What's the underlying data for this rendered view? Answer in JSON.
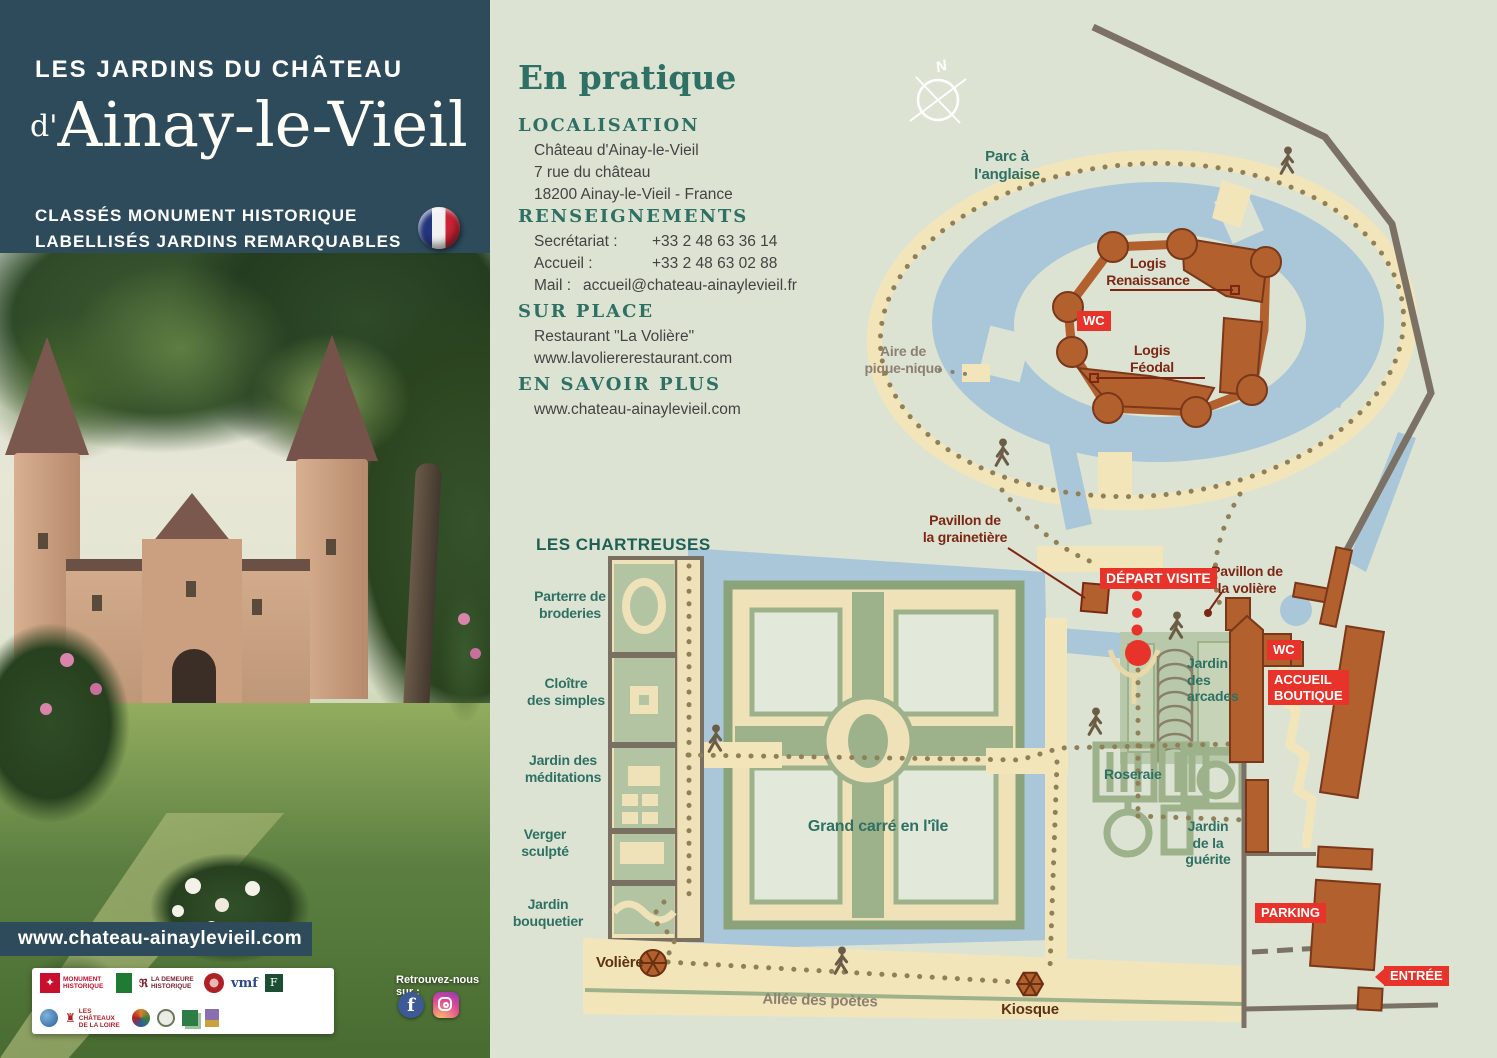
{
  "panel": {
    "title_line1": "LES JARDINS DU CHÂTEAU",
    "title_prefix": "d'",
    "title_main": "Ainay-le-Vieil",
    "subtitle_line1": "CLASSÉS MONUMENT HISTORIQUE",
    "subtitle_line2": "LABELLISÉS JARDINS REMARQUABLES",
    "website_banner": "www.chateau-ainaylevieil.com",
    "follow_label": "Retrouvez-nous sur :",
    "partners": [
      "MONUMENT\nHISTORIQUE",
      "LA DEMEURE\nHISTORIQUE",
      "vmf",
      "F",
      "LES CHÂTEAUX\nDE LA LOIRE"
    ]
  },
  "info": {
    "title": "En pratique",
    "localisation": {
      "heading": "LOCALISATION",
      "lines": [
        "Château d'Ainay-le-Vieil",
        "7 rue du château",
        "18200 Ainay-le-Vieil - France"
      ]
    },
    "renseignements": {
      "heading": "RENSEIGNEMENTS",
      "rows": [
        [
          "Secrétariat :",
          "+33 2 48 63 36 14"
        ],
        [
          "Accueil :",
          "+33 2 48 63 02 88"
        ]
      ],
      "mail_label": "Mail :",
      "mail_value": "accueil@chateau-ainaylevieil.fr"
    },
    "sur_place": {
      "heading": "SUR PLACE",
      "lines": [
        "Restaurant \"La Volière\"",
        "www.lavoliererestaurant.com"
      ]
    },
    "en_savoir_plus": {
      "heading": "EN SAVOIR PLUS",
      "lines": [
        "www.chateau-ainaylevieil.com"
      ]
    }
  },
  "map": {
    "compass": "N",
    "labels": {
      "parc": [
        "Parc à",
        "l'anglaise"
      ],
      "renaissance": [
        "Logis",
        "Renaissance"
      ],
      "feodal": [
        "Logis",
        "Féodal"
      ],
      "pique_nique": [
        "Aire de",
        "pique-nique"
      ],
      "chartreuses": "LES CHARTREUSES",
      "parterre": [
        "Parterre de",
        "broderies"
      ],
      "cloitre": [
        "Cloître",
        "des simples"
      ],
      "meditations": [
        "Jardin des",
        "méditations"
      ],
      "verger": [
        "Verger",
        "sculpté"
      ],
      "bouquetier": [
        "Jardin",
        "bouquetier"
      ],
      "grainetiere": [
        "Pavillon de",
        "la grainetière"
      ],
      "pavillon_voliere": [
        "Pavillon de",
        "la volière"
      ],
      "arcades": [
        "Jardin",
        "des",
        "arcades"
      ],
      "roseraie": "Roseraie",
      "guerite": [
        "Jardin",
        "de la",
        "guérite"
      ],
      "grand_carre": "Grand carré en l'île",
      "voliere": "Volière",
      "kiosque": "Kiosque",
      "allee": "Allée des poètes"
    },
    "badges": {
      "wc": "WC",
      "depart": "DÉPART VISITE",
      "accueil_line1": "ACCUEIL",
      "accueil_line2": "BOUTIQUE",
      "parking": "PARKING",
      "entree": "ENTRÉE"
    }
  },
  "colors": {
    "header_teal": "#2d4b5b",
    "heading_teal": "#2e7164",
    "map_red": "#e8332a",
    "building_brown": "#b3602f",
    "water_blue": "#a9c7d8",
    "path_beige": "#f3e5ba",
    "map_background": "#dde3d3"
  }
}
